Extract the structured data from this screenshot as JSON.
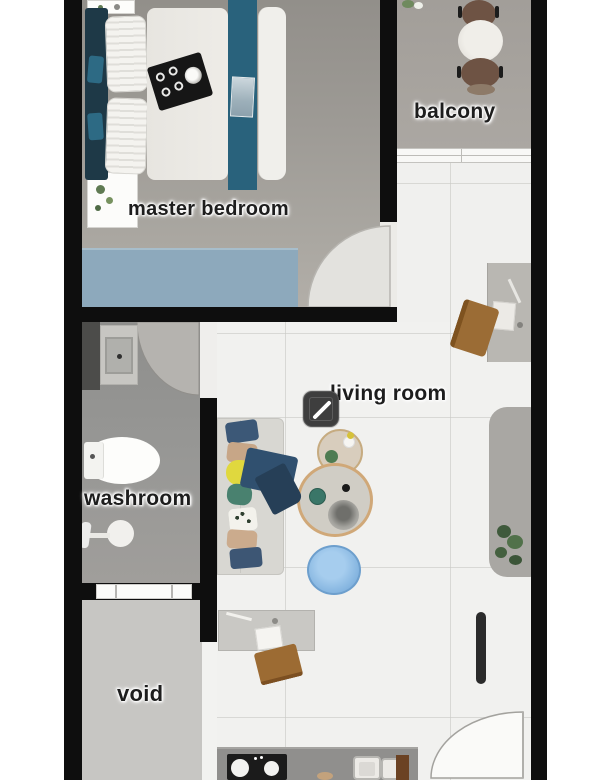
{
  "plan": {
    "title": "apartment floor plan",
    "rooms": {
      "master_bedroom": {
        "label": "master bedroom"
      },
      "balcony": {
        "label": "balcony"
      },
      "living_room": {
        "label": "living room"
      },
      "washroom": {
        "label": "washroom"
      },
      "void": {
        "label": "void"
      }
    },
    "icons": {
      "edit": {
        "name": "edit-pencil-icon",
        "glyph": "/"
      }
    }
  },
  "colors": {
    "wall": "#0e0e0e",
    "bedroom_accent_teal": "#29627c",
    "rug_blue": "#8da9bc",
    "pouf_blue": "#85b5e0",
    "living_floor": "#f1f1ef",
    "washroom_floor": "#979795",
    "void_floor": "#c7c6c3",
    "balcony_floor": "#a7a39e",
    "chair_brown": "#9c6b33",
    "balcony_chair_brown": "#6e5344"
  },
  "furniture": {
    "sofa": {
      "pillows": [
        {
          "color": "#3c5877",
          "left": 226,
          "top": 421,
          "w": 32,
          "h": 21,
          "rot": -8,
          "r": 4
        },
        {
          "color": "#c7a687",
          "left": 227,
          "top": 443,
          "w": 30,
          "h": 20,
          "rot": 6,
          "r": 5
        },
        {
          "color": "#e0d83e",
          "left": 226,
          "top": 460,
          "w": 27,
          "h": 25,
          "rot": 0,
          "r": 12
        },
        {
          "color": "#49816f",
          "left": 227,
          "top": 484,
          "w": 25,
          "h": 21,
          "rot": 5,
          "r": 9
        },
        {
          "color": "#f3f2ec",
          "left": 229,
          "top": 508,
          "w": 28,
          "h": 23,
          "rot": -6,
          "r": 5,
          "pattern": true
        },
        {
          "color": "#cbab8d",
          "left": 227,
          "top": 530,
          "w": 30,
          "h": 19,
          "rot": 4,
          "r": 5
        },
        {
          "color": "#3d5674",
          "left": 230,
          "top": 548,
          "w": 32,
          "h": 20,
          "rot": -5,
          "r": 4
        }
      ]
    }
  }
}
